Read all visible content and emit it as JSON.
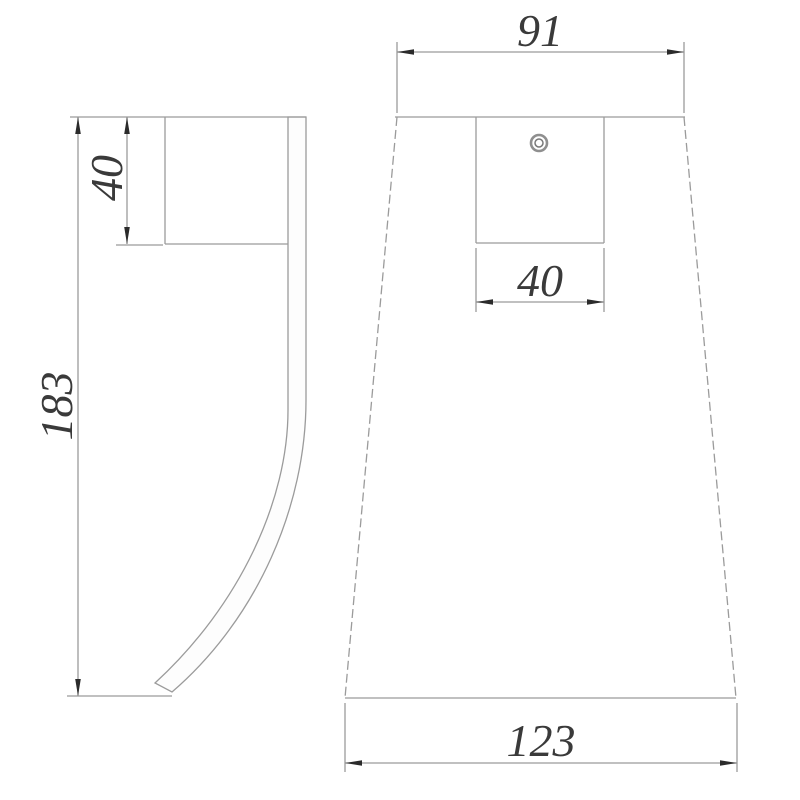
{
  "drawing": {
    "kind": "technical-dimension-drawing",
    "background": "#ffffff",
    "line_color": "#9b9b9b",
    "text_color": "#3a3a3a",
    "arrow_color": "#2b2b2b",
    "views": [
      {
        "name": "side-profile-view",
        "description": "side view of wall bracket with curved strip",
        "dimensions": [
          {
            "label": "40",
            "orientation": "vertical"
          },
          {
            "label": "183",
            "orientation": "vertical"
          }
        ]
      },
      {
        "name": "front-view",
        "description": "front view, tapered trapezoid body with mounting plate and screw hole",
        "features": [
          {
            "name": "screw-hole"
          }
        ],
        "dimensions": [
          {
            "label": "91",
            "orientation": "horizontal"
          },
          {
            "label": "40",
            "orientation": "horizontal"
          },
          {
            "label": "123",
            "orientation": "horizontal"
          }
        ]
      }
    ]
  }
}
